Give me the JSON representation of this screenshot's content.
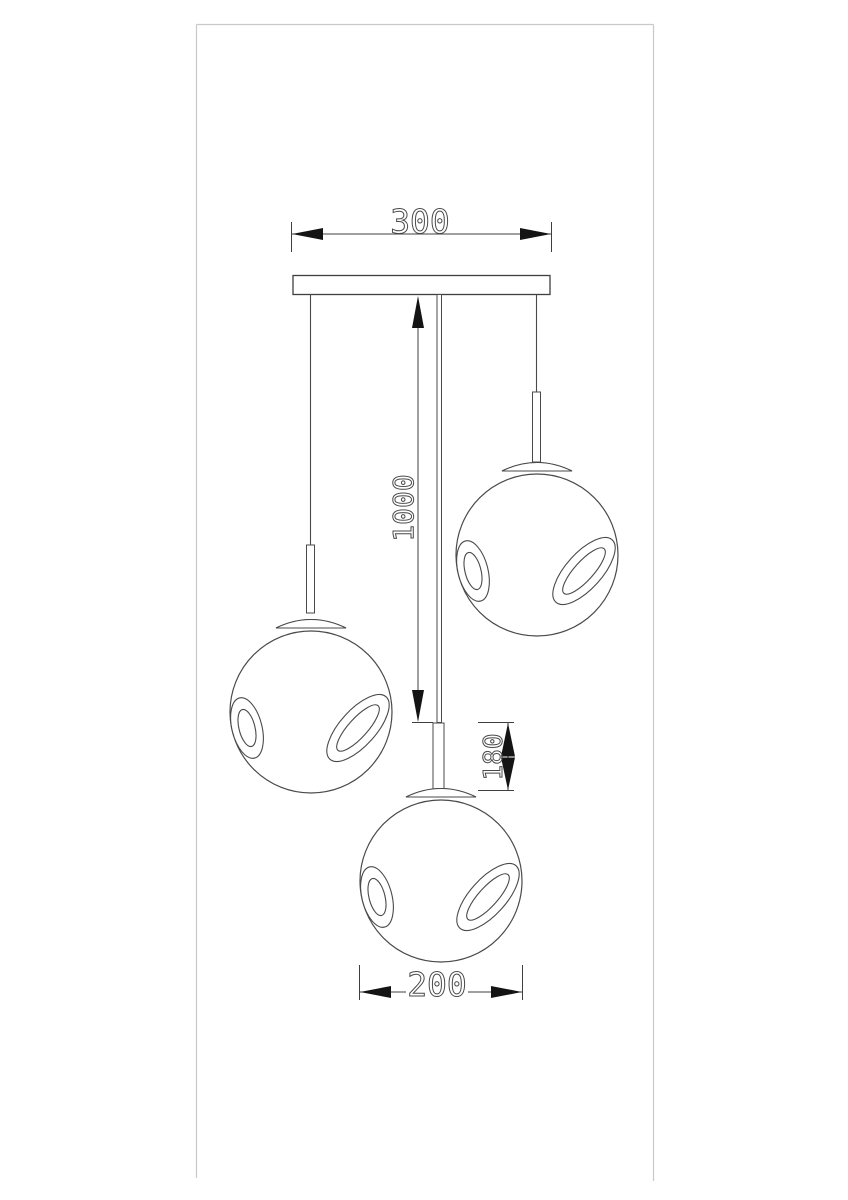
{
  "drawing": {
    "kind": "pendant-lamp-technical-drawing",
    "dimensions": {
      "canopy_width": "300",
      "suspension_drop": "1000",
      "stem_height": "180",
      "shade_diameter": "200"
    },
    "colors": {
      "background": "#ffffff",
      "outline": "#4a4a4a",
      "dimension_line": "#3f3f3f",
      "arrow_fill": "#141414",
      "frame_border": "#c9c9c9"
    }
  }
}
